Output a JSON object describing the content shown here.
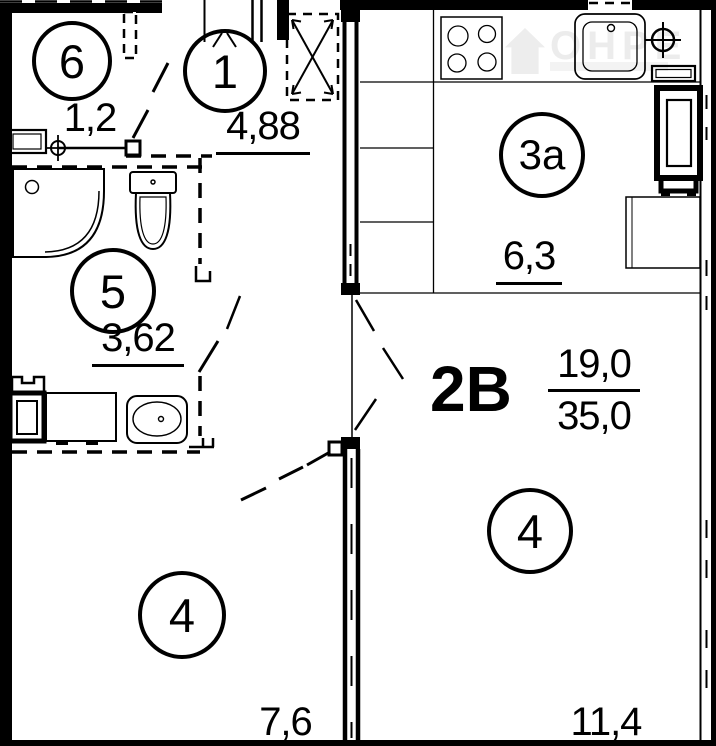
{
  "plan": {
    "type_label": "2В",
    "area_living": "19,0",
    "area_total": "35,0",
    "watermark": "ОНРЕ",
    "rooms": [
      {
        "id": "6",
        "area": "1,2"
      },
      {
        "id": "1",
        "area": "4,88"
      },
      {
        "id": "5",
        "area": "3,62"
      },
      {
        "id": "3а",
        "area": "6,3"
      },
      {
        "id": "4",
        "area": "7,6"
      },
      {
        "id": "4",
        "area": "11,4"
      }
    ]
  }
}
